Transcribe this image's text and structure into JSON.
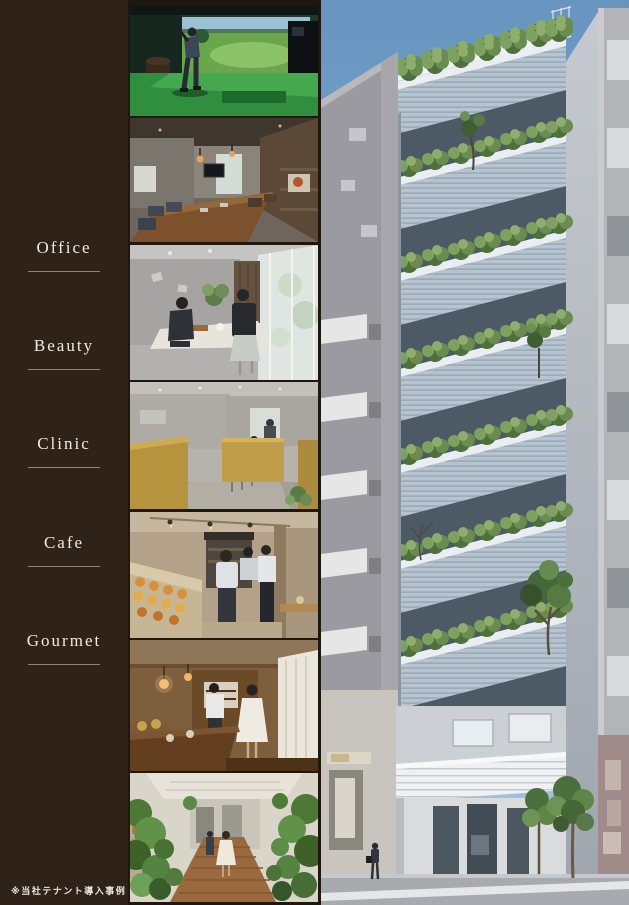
{
  "sidebar": {
    "items": [
      {
        "label": "Office"
      },
      {
        "label": "Beauty"
      },
      {
        "label": "Clinic"
      },
      {
        "label": "Cafe"
      },
      {
        "label": "Gourmet"
      }
    ],
    "footnote": "※当社テナント導入事例"
  },
  "photos": [
    {
      "name": "golf-simulator"
    },
    {
      "name": "office-meeting-room"
    },
    {
      "name": "beauty-salon"
    },
    {
      "name": "clinic-booths"
    },
    {
      "name": "bakery-cafe-counter"
    },
    {
      "name": "gourmet-restaurant"
    },
    {
      "name": "green-entrance-walkway"
    }
  ],
  "rendering": {
    "name": "building-exterior-with-planted-terraces"
  },
  "colors": {
    "sidebar_bg": "#2e2219",
    "sidebar_text": "#f2ecdf",
    "sky": "#6f9cc4",
    "foliage": "#5d7a45",
    "terrace_louver": "#b7c3ce"
  }
}
